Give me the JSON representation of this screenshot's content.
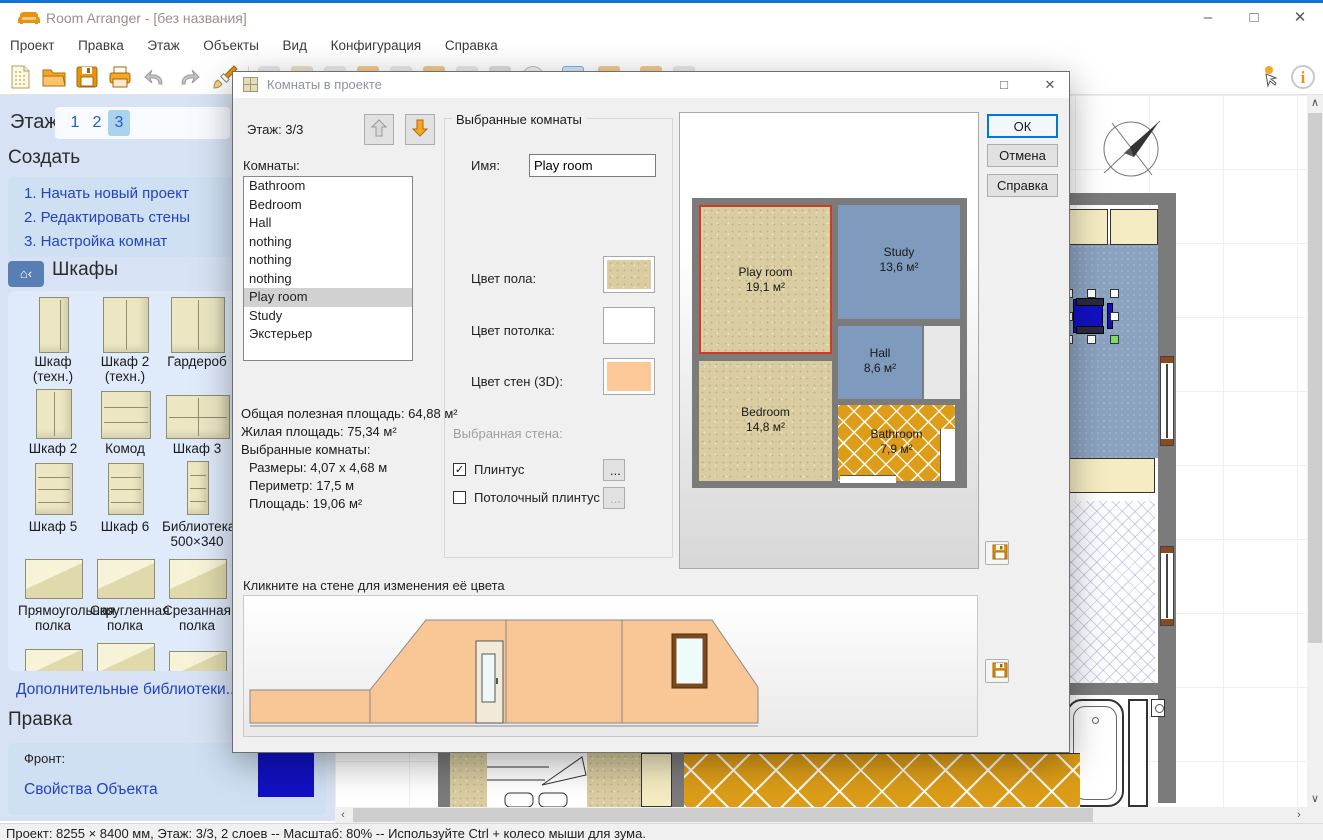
{
  "icons": {
    "check": "✓",
    "minimize": "–",
    "maximize": "□",
    "close": "✕",
    "scroll_up": "∧",
    "scroll_down": "∨",
    "scroll_left": "‹",
    "scroll_right": "›"
  },
  "colors": {
    "accent": "#0078d7",
    "window_border": "#1272d9",
    "sidebar_bg": "#d7e3f4",
    "link_blue": "#2443bd",
    "wall_gray": "#7b7b7b",
    "floor_tan": "#d9cda1",
    "room_blue": "#8ba3c1",
    "bathroom_orange": "#dd9d18",
    "wall_peach": "#f9c795",
    "selection_red": "#cf3a28",
    "object_blue": "#1111c4"
  },
  "window": {
    "title": "Room Arranger - [без названия]"
  },
  "menu": [
    "Проект",
    "Правка",
    "Этаж",
    "Объекты",
    "Вид",
    "Конфигурация",
    "Справка"
  ],
  "sidebar": {
    "floor_label": "Этаж",
    "tabs": [
      "1",
      "2",
      "3"
    ],
    "active_tab": "3",
    "create_header": "Создать",
    "steps": [
      "1. Начать новый проект",
      "2. Редактировать стены",
      "3. Настройка комнат"
    ],
    "cabinets_header": "Шкафы",
    "furniture": [
      {
        "label": "Шкаф\n(техн.)"
      },
      {
        "label": "Шкаф 2\n(техн.)"
      },
      {
        "label": "Гардероб"
      },
      {
        "label": "Ш"
      },
      {
        "label": "Шкаф 2"
      },
      {
        "label": "Комод"
      },
      {
        "label": "Шкаф 3"
      },
      {
        "label": "Шк"
      },
      {
        "label": "Шкаф 5"
      },
      {
        "label": "Шкаф 6"
      },
      {
        "label": "Библиотека;\n500×340"
      },
      {
        "label": "Би\n1"
      },
      {
        "label": "Прямоугольная\nполка"
      },
      {
        "label": "Скругленная\nполка"
      },
      {
        "label": "Срезанная\nполка"
      }
    ],
    "more_link": "Дополнительные библиотеки..",
    "edit_header": "Правка",
    "front_label": "Фронт:",
    "props_link": "Свойства Объекта"
  },
  "dialog": {
    "title": "Комнаты в проекте",
    "floor_info": "Этаж: 3/3",
    "rooms_label": "Комнаты:",
    "rooms": [
      "Bathroom",
      "Bedroom",
      "Hall",
      "nothing",
      "nothing",
      "nothing",
      "Play room",
      "Study",
      "Экстерьер"
    ],
    "selected_room": "Play room",
    "stats": [
      "Общая полезная площадь: 64,88 м²",
      "Жилая площадь: 75,34 м²",
      "Выбранные комнаты:",
      "Размеры: 4,07 x 4,68 м",
      "Периметр: 17,5 м",
      "Площадь: 19,06 м²"
    ],
    "group_title": "Выбранные комнаты",
    "name_label": "Имя:",
    "name_value": "Play room",
    "floor_color_label": "Цвет пола:",
    "ceiling_color_label": "Цвет потолка:",
    "walls_color_label": "Цвет стен (3D):",
    "selected_wall_label": "Выбранная стена:",
    "plinth_label": "Плинтус",
    "plinth_checked": true,
    "ceiling_plinth_label": "Потолочный плинтус",
    "ceiling_plinth_checked": false,
    "ellipsis": "...",
    "ok": "ОК",
    "cancel": "Отмена",
    "help": "Справка",
    "hint": "Кликните на стене для изменения её цвета",
    "preview_rooms": [
      {
        "name": "Play room",
        "area": "19,1 м²"
      },
      {
        "name": "Study",
        "area": "13,6 м²"
      },
      {
        "name": "Hall",
        "area": "8,6 м²"
      },
      {
        "name": "Bedroom",
        "area": "14,8 м²"
      },
      {
        "name": "Bathroom",
        "area": "7,9 м²"
      }
    ]
  },
  "status": "Проект: 8255 × 8400 мм, Этаж: 3/3, 2 слоев -- Масштаб: 80% -- Используйте Ctrl + колесо мыши для зума."
}
